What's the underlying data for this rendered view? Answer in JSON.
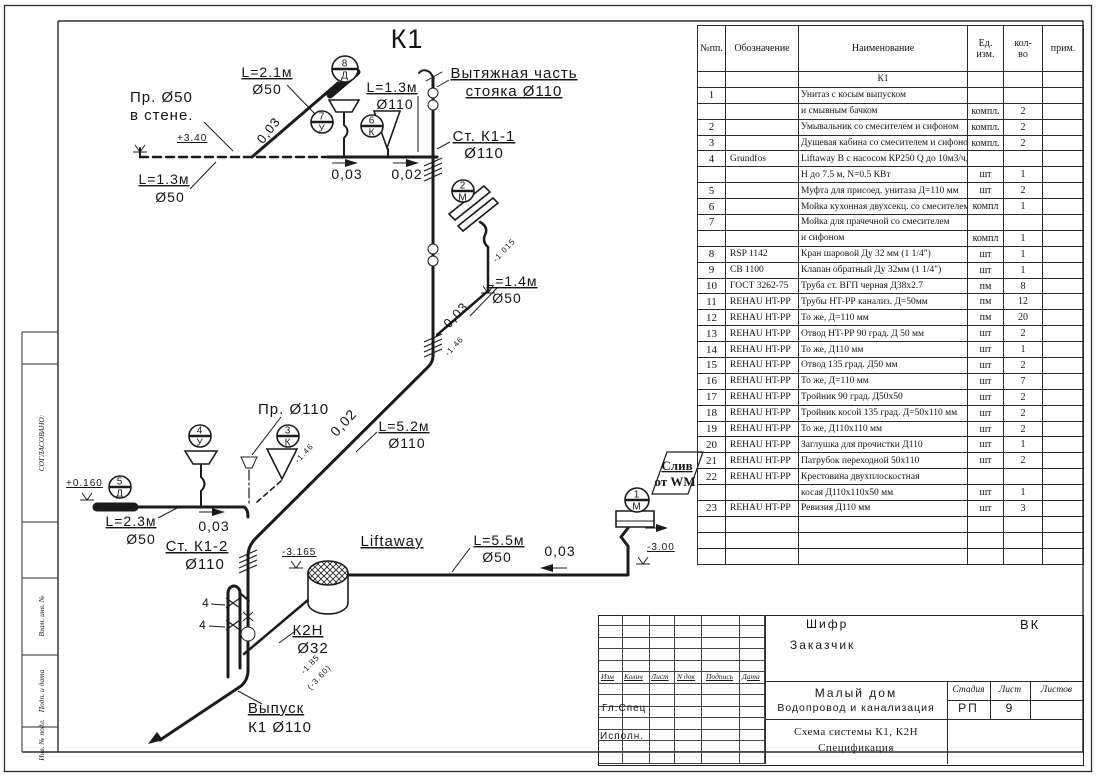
{
  "page_title": "Схема системы К1, К2Н. Спецификация",
  "diagram": {
    "title": "К1",
    "labels": [
      {
        "text": "К1",
        "x": 407,
        "y": 48,
        "size": 27,
        "anchor": "middle",
        "ls": 3
      },
      {
        "text": "Вытяжная часть",
        "x": 514,
        "y": 78,
        "size": 15,
        "anchor": "middle",
        "u": true
      },
      {
        "text": "стояка Ø110",
        "x": 514,
        "y": 96,
        "size": 15,
        "anchor": "middle",
        "u": true
      },
      {
        "text": "Пр. Ø50",
        "x": 130,
        "y": 102,
        "size": 15,
        "anchor": "start"
      },
      {
        "text": "в стене.",
        "x": 130,
        "y": 120,
        "size": 15,
        "anchor": "start"
      },
      {
        "text": "+3.40",
        "x": 177,
        "y": 141,
        "size": 10,
        "anchor": "start",
        "u": true
      },
      {
        "text": "L=2.1м",
        "x": 267,
        "y": 77,
        "size": 14,
        "anchor": "middle",
        "u": true
      },
      {
        "text": "Ø50",
        "x": 267,
        "y": 94,
        "size": 14,
        "anchor": "middle"
      },
      {
        "text": "0,03",
        "x": 272,
        "y": 133,
        "size": 13,
        "anchor": "middle",
        "rot": -52
      },
      {
        "text": "L=1.3м",
        "x": 392,
        "y": 92,
        "size": 14,
        "anchor": "middle",
        "u": true
      },
      {
        "text": "Ø110",
        "x": 395,
        "y": 109,
        "size": 14,
        "anchor": "middle"
      },
      {
        "text": "Ст. К1-1",
        "x": 484,
        "y": 141,
        "size": 15,
        "anchor": "middle",
        "u": true
      },
      {
        "text": "Ø110",
        "x": 484,
        "y": 158,
        "size": 15,
        "anchor": "middle"
      },
      {
        "text": "0,03",
        "x": 347,
        "y": 179,
        "size": 14,
        "anchor": "middle"
      },
      {
        "text": "0,02",
        "x": 407,
        "y": 179,
        "size": 14,
        "anchor": "middle"
      },
      {
        "text": "L=1.3м",
        "x": 164,
        "y": 184,
        "size": 14,
        "anchor": "middle",
        "u": true
      },
      {
        "text": "Ø50",
        "x": 170,
        "y": 202,
        "size": 14,
        "anchor": "middle"
      },
      {
        "text": "L=1.4м",
        "x": 512,
        "y": 286,
        "size": 14,
        "anchor": "middle",
        "u": true
      },
      {
        "text": "Ø50",
        "x": 507,
        "y": 303,
        "size": 14,
        "anchor": "middle"
      },
      {
        "text": "0,03",
        "x": 459,
        "y": 318,
        "size": 13,
        "anchor": "middle",
        "rot": -47
      },
      {
        "text": "-1.015",
        "x": 506,
        "y": 252,
        "size": 8,
        "anchor": "middle",
        "rot": -47
      },
      {
        "text": "-1.46",
        "x": 456,
        "y": 348,
        "size": 8,
        "anchor": "middle",
        "rot": -47
      },
      {
        "text": "Пр. Ø110",
        "x": 258,
        "y": 414,
        "size": 15,
        "anchor": "start"
      },
      {
        "text": "L=5.2м",
        "x": 404,
        "y": 431,
        "size": 14,
        "anchor": "middle",
        "u": true
      },
      {
        "text": "Ø110",
        "x": 407,
        "y": 448,
        "size": 14,
        "anchor": "middle"
      },
      {
        "text": "0,02",
        "x": 347,
        "y": 426,
        "size": 14,
        "anchor": "middle",
        "rot": -47
      },
      {
        "text": "-1.46",
        "x": 306,
        "y": 455,
        "size": 8,
        "anchor": "middle",
        "rot": -47
      },
      {
        "text": "+0.160",
        "x": 66,
        "y": 486,
        "size": 10,
        "anchor": "start",
        "u": true
      },
      {
        "text": "L=2.3м",
        "x": 131,
        "y": 526,
        "size": 14,
        "anchor": "middle",
        "u": true
      },
      {
        "text": "Ø50",
        "x": 141,
        "y": 544,
        "size": 14,
        "anchor": "middle"
      },
      {
        "text": "0,03",
        "x": 214,
        "y": 531,
        "size": 14,
        "anchor": "middle"
      },
      {
        "text": "Ст. К1-2",
        "x": 197,
        "y": 551,
        "size": 15,
        "anchor": "middle",
        "u": true
      },
      {
        "text": "Ø110",
        "x": 205,
        "y": 569,
        "size": 15,
        "anchor": "middle"
      },
      {
        "text": "-3.165",
        "x": 282,
        "y": 555,
        "size": 10,
        "anchor": "start",
        "u": true
      },
      {
        "text": "Liftaway",
        "x": 392,
        "y": 546,
        "size": 15,
        "anchor": "middle",
        "u": true
      },
      {
        "text": "L=5.5м",
        "x": 499,
        "y": 545,
        "size": 14,
        "anchor": "middle",
        "u": true
      },
      {
        "text": "Ø50",
        "x": 497,
        "y": 562,
        "size": 14,
        "anchor": "middle"
      },
      {
        "text": "0,03",
        "x": 560,
        "y": 556,
        "size": 14,
        "anchor": "middle"
      },
      {
        "text": "Слив",
        "x": 677,
        "y": 470,
        "size": 13,
        "anchor": "middle",
        "u": true,
        "serif": true
      },
      {
        "text": "от WM",
        "x": 675,
        "y": 486,
        "size": 13,
        "anchor": "middle",
        "serif": true
      },
      {
        "text": "-3.00",
        "x": 647,
        "y": 550,
        "size": 10,
        "anchor": "start",
        "u": true
      },
      {
        "text": "К2Н",
        "x": 308,
        "y": 635,
        "size": 15,
        "anchor": "middle",
        "u": true
      },
      {
        "text": "Ø32",
        "x": 313,
        "y": 653,
        "size": 15,
        "anchor": "middle"
      },
      {
        "text": "4",
        "x": 206,
        "y": 607,
        "size": 12,
        "anchor": "middle"
      },
      {
        "text": "4",
        "x": 203,
        "y": 629,
        "size": 12,
        "anchor": "middle"
      },
      {
        "text": "Выпуск",
        "x": 276,
        "y": 713,
        "size": 15,
        "anchor": "middle",
        "u": true
      },
      {
        "text": "К1 Ø110",
        "x": 280,
        "y": 732,
        "size": 15,
        "anchor": "middle"
      },
      {
        "text": "-1.85",
        "x": 312,
        "y": 666,
        "size": 8,
        "anchor": "middle",
        "rot": -47
      },
      {
        "text": "(-3.60)",
        "x": 321,
        "y": 679,
        "size": 8,
        "anchor": "middle",
        "rot": -47
      }
    ],
    "tags": [
      {
        "num": "8",
        "letter": "Д",
        "cx": 345,
        "cy": 69,
        "r": 13
      },
      {
        "num": "7",
        "letter": "У",
        "cx": 322,
        "cy": 122,
        "r": 11
      },
      {
        "num": "6",
        "letter": "К",
        "cx": 372,
        "cy": 126,
        "r": 11
      },
      {
        "num": "2",
        "letter": "М",
        "cx": 463,
        "cy": 191,
        "r": 11
      },
      {
        "num": "4",
        "letter": "У",
        "cx": 200,
        "cy": 436,
        "r": 11
      },
      {
        "num": "3",
        "letter": "К",
        "cx": 288,
        "cy": 436,
        "r": 11
      },
      {
        "num": "5",
        "letter": "Д",
        "cx": 120,
        "cy": 487,
        "r": 11
      },
      {
        "num": "1",
        "letter": "М",
        "cx": 637,
        "cy": 500,
        "r": 12
      }
    ]
  },
  "sidebar": {
    "cells": [
      {
        "label": "СОГЛАСОВАНО:",
        "cy": 443
      },
      {
        "label": "Взам. инв. №",
        "cy": 616
      },
      {
        "label": "Подп. и дата",
        "cy": 691
      },
      {
        "label": "Инв. № подл.",
        "cy": 740
      }
    ]
  },
  "spec_table": {
    "headers": [
      "№пп.",
      "Обозначение",
      "Наименование",
      "Ед.\nизм.",
      "кол-\nво",
      "прим."
    ],
    "rows": [
      [
        "",
        "",
        "К1",
        "",
        "",
        ""
      ],
      [
        "1",
        "",
        "Унитаз с косым выпуском",
        "",
        "",
        ""
      ],
      [
        "",
        "",
        "и смывным бачком",
        "компл.",
        "2",
        ""
      ],
      [
        "2",
        "",
        "Умывальник со смесителем и сифоном",
        "компл.",
        "2",
        ""
      ],
      [
        "3",
        "",
        "Душевая кабина со смесителем и сифоном",
        "компл.",
        "2",
        ""
      ],
      [
        "4",
        "Grundfos",
        "Liftaway B с насосом КР250 Q до 10м3/ч,",
        "",
        "",
        ""
      ],
      [
        "",
        "",
        "Н до 7.5 м, N=0.5 КВт",
        "шт",
        "1",
        ""
      ],
      [
        "5",
        "",
        "Муфта для присоед. унитаза Д=110 мм",
        "шт",
        "2",
        ""
      ],
      [
        "6",
        "",
        "Мойка кухонная двухсекц. со смесителем",
        "компл",
        "1",
        ""
      ],
      [
        "7",
        "",
        "Мойка для прачечной со смесителем",
        "",
        "",
        ""
      ],
      [
        "",
        "",
        "и сифоном",
        "компл",
        "1",
        ""
      ],
      [
        "8",
        "RSP 1142",
        "Кран шаровой Ду 32 мм (1 1/4\")",
        "шт",
        "1",
        ""
      ],
      [
        "9",
        "СВ 1100",
        "Клапан обратный Ду 32мм (1 1/4\")",
        "шт",
        "1",
        ""
      ],
      [
        "10",
        "ГОСТ 3262-75",
        "Труба ст. ВГП черная Д38х2.7",
        "пм",
        "8",
        ""
      ],
      [
        "11",
        "REHAU HT-PP",
        "Трубы НТ-РР канализ. Д=50мм",
        "пм",
        "12",
        ""
      ],
      [
        "12",
        "REHAU HT-PP",
        "То же, Д=110 мм",
        "пм",
        "20",
        ""
      ],
      [
        "13",
        "REHAU HT-PP",
        "Отвод НТ-РР 90 град. Д 50 мм",
        "шт",
        "2",
        ""
      ],
      [
        "14",
        "REHAU HT-PP",
        "То же, Д110 мм",
        "шт",
        "1",
        ""
      ],
      [
        "15",
        "REHAU HT-PP",
        "Отвод 135 град. Д50 мм",
        "шт",
        "2",
        ""
      ],
      [
        "16",
        "REHAU HT-PP",
        "То же, Д=110 мм",
        "шт",
        "7",
        ""
      ],
      [
        "17",
        "REHAU HT-PP",
        "Тройник 90 град. Д50х50",
        "шт",
        "2",
        ""
      ],
      [
        "18",
        "REHAU HT-PP",
        "Тройник косой 135 град. Д=50х110 мм",
        "шт",
        "2",
        ""
      ],
      [
        "19",
        "REHAU HT-PP",
        "То же, Д110х110 мм",
        "шт",
        "2",
        ""
      ],
      [
        "20",
        "REHAU HT-PP",
        "Заглушка для прочистки Д110",
        "шт",
        "1",
        ""
      ],
      [
        "21",
        "REHAU HT-PP",
        "Патрубок переходной 50х110",
        "шт",
        "2",
        ""
      ],
      [
        "22",
        "REHAU HT-PP",
        "Крестовина двухплоскостная",
        "",
        "",
        ""
      ],
      [
        "",
        "",
        "косая Д110х110х50 мм",
        "шт",
        "1",
        ""
      ],
      [
        "23",
        "REHAU HT-PP",
        "Ревизия  Д110 мм",
        "шт",
        "3",
        ""
      ],
      [
        "",
        "",
        "",
        "",
        "",
        ""
      ],
      [
        "",
        "",
        "",
        "",
        "",
        ""
      ],
      [
        "",
        "",
        "",
        "",
        "",
        ""
      ]
    ]
  },
  "title_block": {
    "code_label": "Шифр",
    "code_value": "ВК",
    "customer_label": "Заказчик",
    "rev_headers": [
      "Изм",
      "Колич",
      "Лист",
      "N док",
      "Подпись",
      "Дата"
    ],
    "chief_label": "Гл.Спец",
    "executor_label": "Исполн.",
    "project_line1": "Малый дом",
    "project_line2": "Водопровод и канализация",
    "sheet_line1": "Схема системы К1, К2Н",
    "sheet_line2": "Спецификация",
    "stage_label": "Стадия",
    "stage_value": "РП",
    "sheet_label": "Лист",
    "sheet_value": "9",
    "sheets_label": "Листов",
    "sheets_value": ""
  }
}
